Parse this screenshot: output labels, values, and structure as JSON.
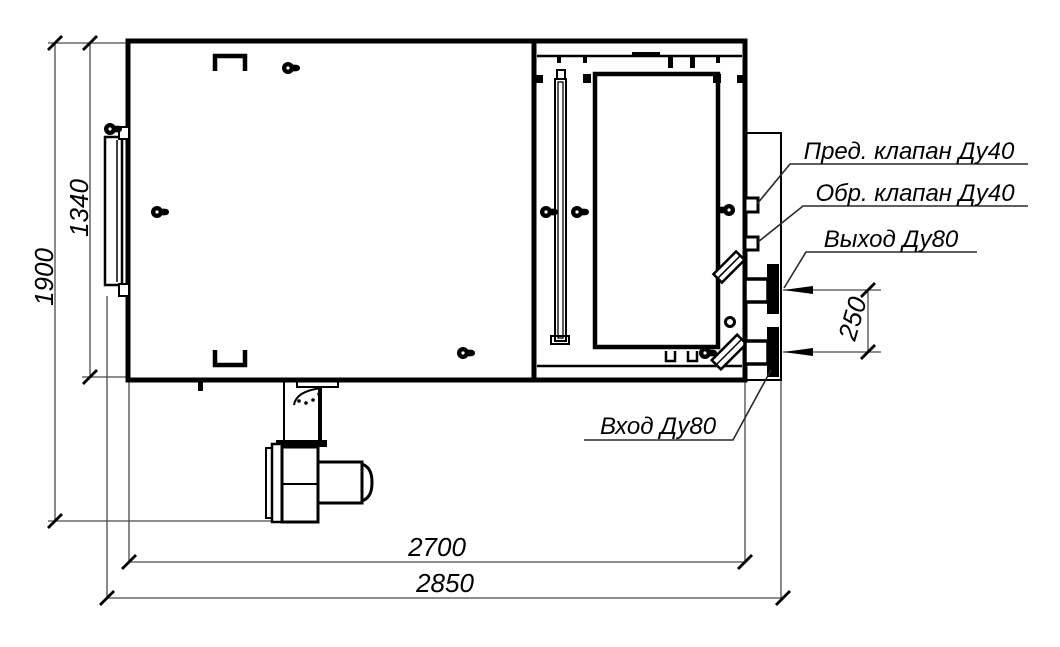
{
  "drawing": {
    "colors": {
      "line": "#000000",
      "background": "#ffffff"
    },
    "dimensions": {
      "overall_height": "1900",
      "body_height": "1340",
      "body_length": "2700",
      "overall_length": "2850",
      "pipe_offset": "250"
    },
    "callouts": {
      "safety_valve": "Пред. клапан Ду40",
      "check_valve": "Обр. клапан Ду40",
      "outlet": "Выход Ду80",
      "inlet": "Вход Ду80"
    }
  }
}
